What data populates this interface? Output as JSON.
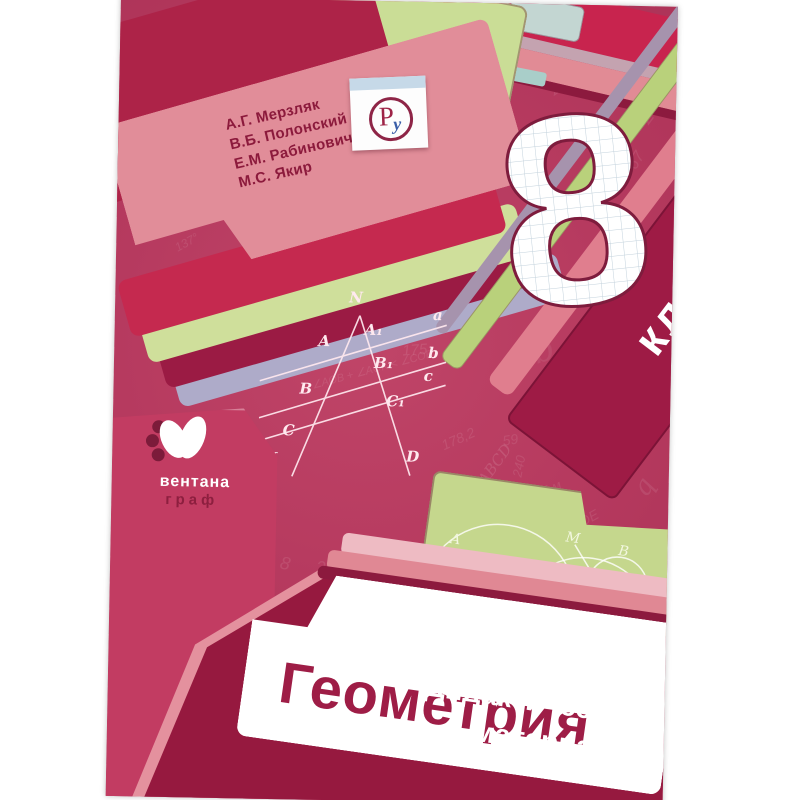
{
  "cover": {
    "title": "Геометрия",
    "subtitle_line1": "Дидактические",
    "subtitle_line2": "материалы",
    "grade": {
      "digit": "8",
      "label": "класс"
    },
    "authors": [
      "А.Г. Мерзляк",
      "В.Б. Полонский",
      "Е.М. Рабинович",
      "М.С. Якир"
    ],
    "publisher": {
      "name_line1": "вентана",
      "name_line2": "граф",
      "logo_letters": {
        "p": "Р",
        "u": "у"
      }
    },
    "colors": {
      "background": "#b63a5f",
      "dark_maroon": "#9e1b45",
      "bottom_folder": "#96193f",
      "author_card": "#e18d99",
      "pale_green": "#cadd96",
      "salmon": "#e18b95",
      "lavender": "#aeabc9",
      "title_text": "#9e1d46",
      "logo_blue": "#3a5ea8",
      "grid_line": "#c3d2dc"
    },
    "figure_labels": [
      {
        "t": "N",
        "x": 88,
        "y": -2
      },
      {
        "t": "A",
        "x": 58,
        "y": 42
      },
      {
        "t": "B",
        "x": 40,
        "y": 90
      },
      {
        "t": "C",
        "x": 24,
        "y": 132
      },
      {
        "t": "K",
        "x": 6,
        "y": 160
      },
      {
        "t": "D",
        "x": 148,
        "y": 156
      },
      {
        "t": "A₁",
        "x": 104,
        "y": 30
      },
      {
        "t": "B₁",
        "x": 114,
        "y": 63
      },
      {
        "t": "C₁",
        "x": 127,
        "y": 101
      },
      {
        "t": "a",
        "x": 172,
        "y": 14
      },
      {
        "t": "b",
        "x": 168,
        "y": 52
      },
      {
        "t": "c",
        "x": 164,
        "y": 75
      }
    ],
    "sketch_labels": [
      {
        "t": "A",
        "x": 24,
        "y": 56
      },
      {
        "t": "M",
        "x": 138,
        "y": 38
      },
      {
        "t": "B",
        "x": 192,
        "y": 44
      }
    ],
    "background_tokens": [
      {
        "t": "∠AOK = 125°",
        "x": 424,
        "y": 58,
        "r": -35,
        "s": 13
      },
      {
        "t": "∠COE",
        "x": 516,
        "y": 92,
        "r": -55,
        "s": 14
      },
      {
        "t": "67",
        "x": 510,
        "y": 146,
        "r": -60,
        "s": 16
      },
      {
        "t": "37",
        "x": 298,
        "y": 54,
        "r": 20,
        "s": 12
      },
      {
        "t": "57",
        "x": 366,
        "y": 118,
        "r": -40,
        "s": 13
      },
      {
        "t": "3,7",
        "x": 220,
        "y": 246,
        "r": 0,
        "s": 14
      },
      {
        "t": "231",
        "x": 256,
        "y": 250,
        "r": -8,
        "s": 13
      },
      {
        "t": "m",
        "x": 294,
        "y": 224,
        "r": -15,
        "s": 26,
        "serif": true,
        "o": 0.35
      },
      {
        "t": "АВ·ВС",
        "x": 178,
        "y": 270,
        "r": -20,
        "s": 11
      },
      {
        "t": "175",
        "x": 288,
        "y": 340,
        "r": -5,
        "s": 15
      },
      {
        "t": "∠AOB + ∠AOK < ∠COB",
        "x": 196,
        "y": 362,
        "r": -16,
        "s": 11
      },
      {
        "t": "178,2",
        "x": 328,
        "y": 428,
        "r": -25,
        "s": 14
      },
      {
        "t": "ABCD",
        "x": 360,
        "y": 452,
        "r": -55,
        "s": 15,
        "serif": true,
        "o": 0.4
      },
      {
        "t": "59",
        "x": 390,
        "y": 428,
        "r": -10,
        "s": 14
      },
      {
        "t": "240",
        "x": 396,
        "y": 455,
        "r": -80,
        "s": 13
      },
      {
        "t": "240",
        "x": 206,
        "y": 558,
        "r": 0,
        "s": 17
      },
      {
        "t": "8",
        "x": 170,
        "y": 554,
        "r": 10,
        "s": 18
      },
      {
        "t": "35°",
        "x": 138,
        "y": 518,
        "r": -30,
        "s": 15
      },
      {
        "t": "AD",
        "x": 310,
        "y": 545,
        "r": -8,
        "s": 22,
        "serif": true,
        "o": 0.4
      },
      {
        "t": "∠MON",
        "x": 58,
        "y": 288,
        "r": -35,
        "s": 12
      },
      {
        "t": "137°",
        "x": 58,
        "y": 238,
        "r": -30,
        "s": 12
      },
      {
        "t": "b",
        "x": 418,
        "y": 326,
        "r": -20,
        "s": 34,
        "serif": true,
        "o": 0.22
      },
      {
        "t": "C",
        "x": 66,
        "y": 416,
        "r": 10,
        "s": 44,
        "serif": true,
        "o": 0.2
      },
      {
        "t": "8",
        "x": 98,
        "y": 468,
        "r": -15,
        "s": 30,
        "serif": true,
        "o": 0.22
      },
      {
        "t": "З",
        "x": 478,
        "y": 328,
        "r": 15,
        "s": 20,
        "o": 0.3
      },
      {
        "t": "150",
        "x": 498,
        "y": 428,
        "r": -30,
        "s": 13
      },
      {
        "t": "∠AOK=125°",
        "x": 452,
        "y": 398,
        "r": -28,
        "s": 11
      },
      {
        "t": "ЗСМN",
        "x": 504,
        "y": 392,
        "r": -35,
        "s": 13
      },
      {
        "t": "5 м",
        "x": 430,
        "y": 476,
        "r": -25,
        "s": 13
      },
      {
        "t": "∠COB+90°",
        "x": 388,
        "y": 498,
        "r": -15,
        "s": 11
      },
      {
        "t": "∠ADE",
        "x": 448,
        "y": 510,
        "r": -30,
        "s": 14
      },
      {
        "t": "q",
        "x": 524,
        "y": 466,
        "r": -60,
        "s": 26,
        "serif": true,
        "o": 0.3
      },
      {
        "t": "a",
        "x": 236,
        "y": 192,
        "r": -15,
        "s": 20,
        "serif": true,
        "o": 0.3
      },
      {
        "t": "Д",
        "x": 478,
        "y": 244,
        "r": 20,
        "s": 16
      }
    ]
  }
}
